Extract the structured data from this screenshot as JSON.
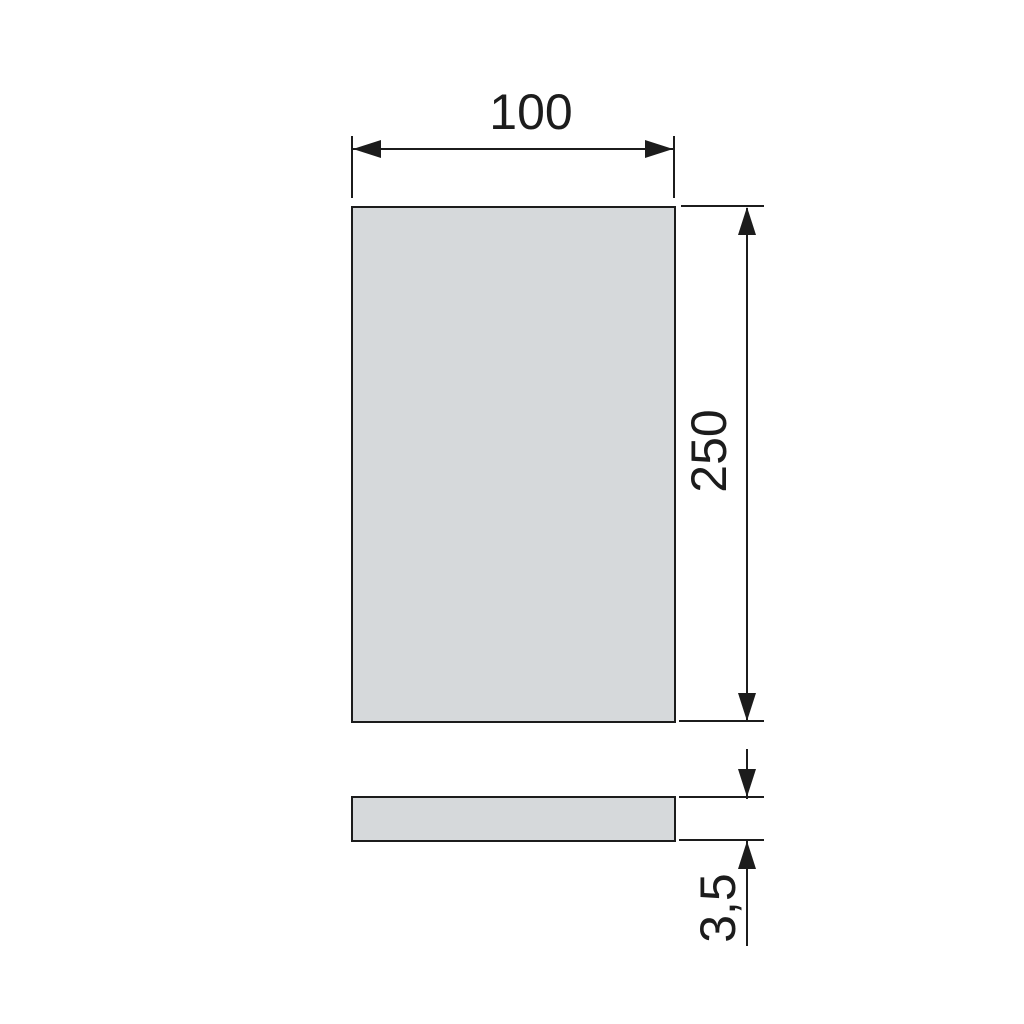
{
  "drawing": {
    "colors": {
      "line": "#1c1c1c",
      "fill": "#d6d9db",
      "background": "#ffffff"
    },
    "dimensions": {
      "width": "100",
      "height": "250",
      "thickness": "3,5"
    }
  }
}
